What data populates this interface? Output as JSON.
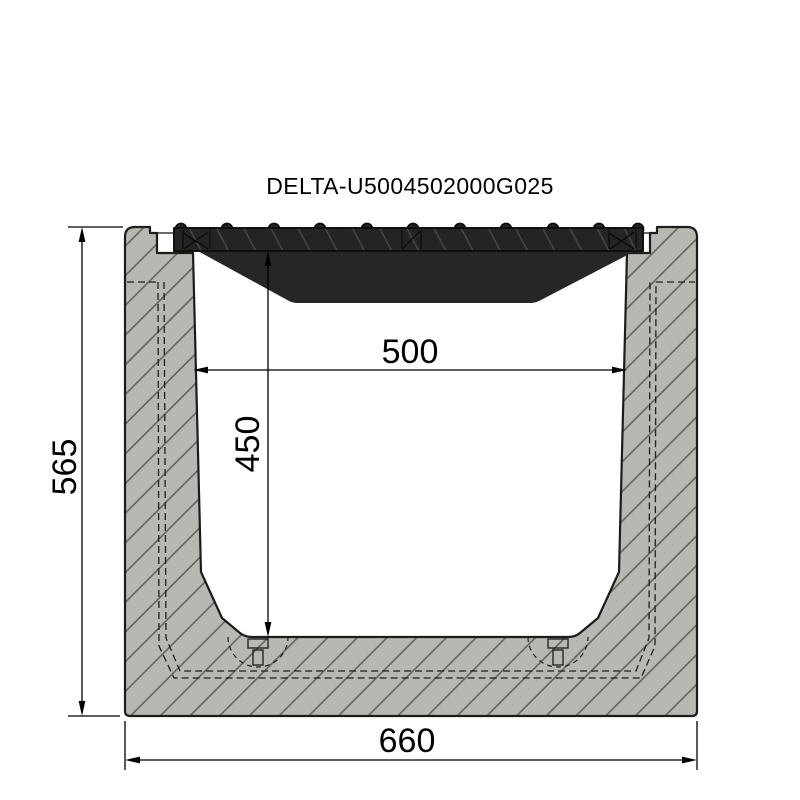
{
  "title": "DELTA-U5004502000G025",
  "drawing": {
    "type": "channel-cross-section",
    "dimensions": {
      "overall_height_mm": "565",
      "inner_width_mm": "500",
      "inner_depth_mm": "450",
      "overall_width_mm": "660"
    }
  },
  "colors": {
    "background": "#ffffff",
    "concrete_fill": "#b6b8b1",
    "concrete_hatch": "#5c5e58",
    "concrete_outline": "#1c1c1c",
    "rebate_surface": "#c2c4be",
    "grate_fill": "#242424",
    "grate_underside_fill": "#262626",
    "grate_hatch": "#474747",
    "grate_outline": "#0e0e0e",
    "dimension_line": "#000000"
  }
}
